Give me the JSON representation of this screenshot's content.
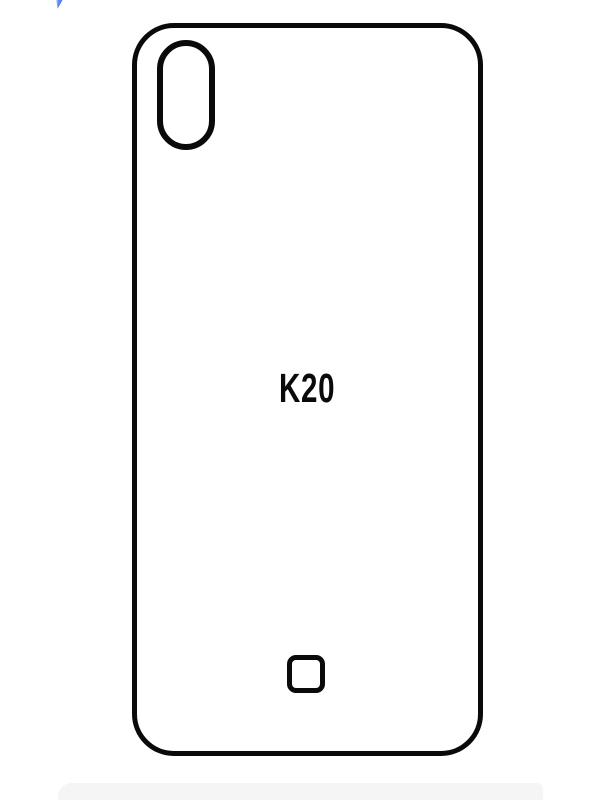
{
  "template": {
    "model_label": "K20"
  },
  "icons": {
    "camera_cutout": "pill-outline",
    "fingerprint_cutout": "rounded-square-outline",
    "cursor_fragment": "blue-pointer-tip"
  },
  "colors": {
    "background": "#ffffff",
    "outline": "#0a0a0a",
    "accent_blue": "#5b80ef",
    "accent_blue_light": "#8aa4f3",
    "footer_gray": "#f5f5f5"
  }
}
